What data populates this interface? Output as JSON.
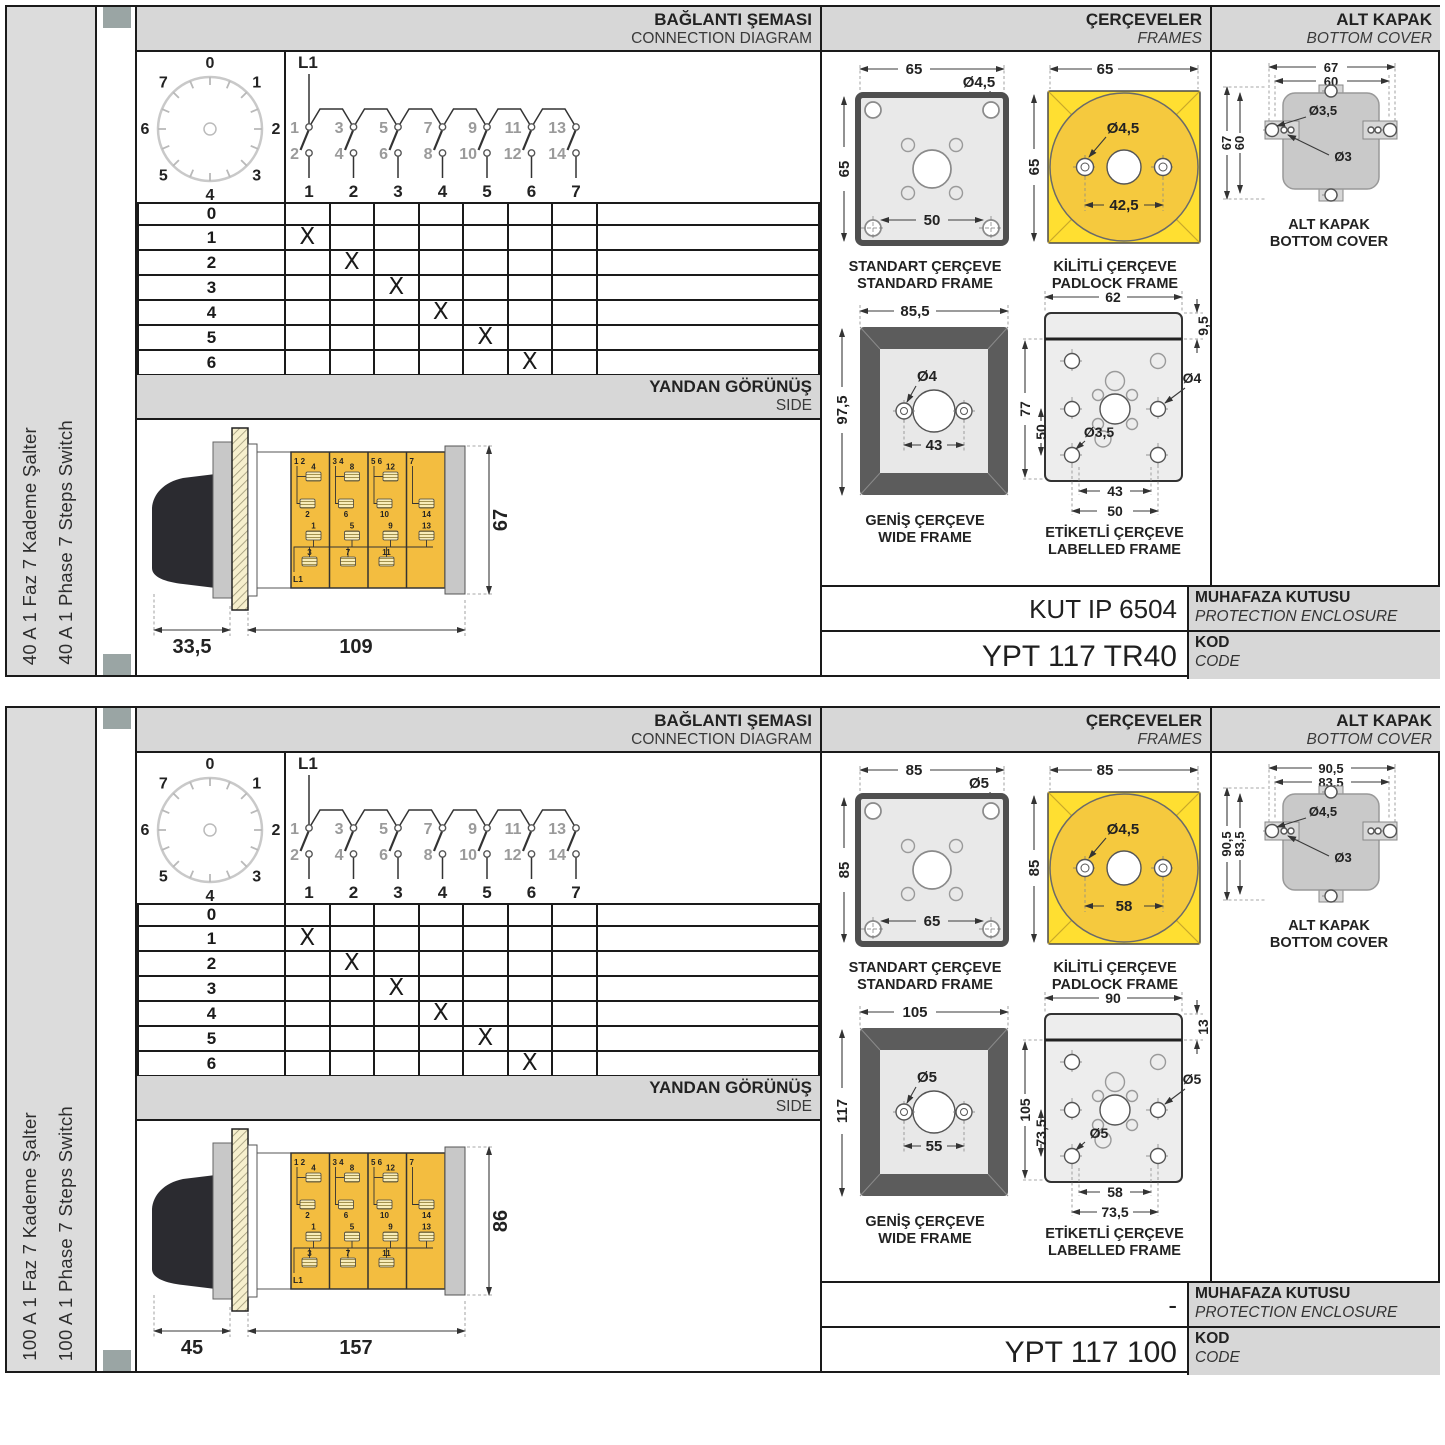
{
  "page": {
    "background": "#ffffff",
    "grid_line": "#1a1a1a",
    "header_bg": "#d7d7d7",
    "sidebar_bg": "#dcdcdc",
    "module_yellow": "#f3bd40",
    "padlock_yellow": "#ffdf31",
    "binder_square": "#9aa5a4"
  },
  "halves": [
    {
      "id": "40a",
      "sidebar": {
        "label_tr": "40 A 1 Faz 7 Kademe Şalter",
        "label_en": "40 A 1 Phase 7 Steps Switch"
      },
      "connection": {
        "title_tr": "BAĞLANTI ŞEMASI",
        "title_en": "CONNECTION DIAGRAM",
        "l1": "L1",
        "dial": [
          "0",
          "1",
          "2",
          "3",
          "4",
          "5",
          "6",
          "7"
        ],
        "top_terminals": [
          "1",
          "3",
          "5",
          "7",
          "9",
          "11",
          "13"
        ],
        "bottom_terminals": [
          "2",
          "4",
          "6",
          "8",
          "10",
          "12",
          "14"
        ],
        "columns": [
          "1",
          "2",
          "3",
          "4",
          "5",
          "6",
          "7"
        ]
      },
      "table": {
        "rows": [
          {
            "label": "0",
            "cells": [
              "",
              "",
              "",
              "",
              "",
              "",
              ""
            ]
          },
          {
            "label": "1",
            "cells": [
              "X",
              "",
              "",
              "",
              "",
              "",
              ""
            ]
          },
          {
            "label": "2",
            "cells": [
              "",
              "X",
              "",
              "",
              "",
              "",
              ""
            ]
          },
          {
            "label": "3",
            "cells": [
              "",
              "",
              "X",
              "",
              "",
              "",
              ""
            ]
          },
          {
            "label": "4",
            "cells": [
              "",
              "",
              "",
              "X",
              "",
              "",
              ""
            ]
          },
          {
            "label": "5",
            "cells": [
              "",
              "",
              "",
              "",
              "X",
              "",
              ""
            ]
          },
          {
            "label": "6",
            "cells": [
              "",
              "",
              "",
              "",
              "",
              "X",
              ""
            ]
          },
          {
            "label": "7",
            "cells": [
              "",
              "",
              "",
              "",
              "",
              "",
              "X"
            ]
          }
        ]
      },
      "side_view": {
        "title_tr": "YANDAN GÖRÜNÜŞ",
        "title_en": "SIDE",
        "dim_depth": "33,5",
        "dim_length": "109",
        "dim_height": "67",
        "l1": "L1",
        "corner_labels": [
          "1  2",
          "3  4",
          "5  6",
          "7"
        ],
        "upper_top_labels": [
          "4",
          "8",
          "12"
        ],
        "upper_bottom_labels": [
          "2",
          "6",
          "10",
          "14"
        ],
        "lower_top_labels": [
          "1",
          "5",
          "9",
          "13"
        ],
        "lower_bottom_labels": [
          "3",
          "7",
          "11"
        ]
      },
      "frames": {
        "title_tr": "ÇERÇEVELER",
        "title_en": "FRAMES",
        "standard": {
          "width": "65",
          "height": "65",
          "hole": "Ø4,5",
          "pitch": "50",
          "caption_tr": "STANDART ÇERÇEVE",
          "caption_en": "STANDARD FRAME"
        },
        "padlock": {
          "width": "65",
          "height": "65",
          "hole": "Ø4,5",
          "pitch": "42,5",
          "caption_tr": "KİLİTLİ ÇERÇEVE",
          "caption_en": "PADLOCK FRAME"
        },
        "wide": {
          "width": "85,5",
          "height": "97,5",
          "hole": "Ø4",
          "pitch": "43",
          "caption_tr": "GENİŞ ÇERÇEVE",
          "caption_en": "WIDE FRAME"
        },
        "labelled": {
          "width": "62",
          "strip_height": "9,5",
          "height": "77",
          "height_inner": "50",
          "hole_right": "Ø4",
          "hole_left": "Ø3,5",
          "pitch_inner": "43",
          "pitch_outer": "50",
          "caption_tr": "ETİKETLİ ÇERÇEVE",
          "caption_en": "LABELLED FRAME"
        }
      },
      "bottom_cover": {
        "title_tr": "ALT KAPAK",
        "title_en": "BOTTOM COVER",
        "width_outer": "67",
        "width_inner": "60",
        "height_outer": "67",
        "height_inner": "60",
        "hole_tab": "Ø3,5",
        "hole_small": "Ø3",
        "caption_tr": "ALT KAPAK",
        "caption_en": "BOTTOM COVER"
      },
      "enclosure": {
        "value": "KUT IP 6504",
        "label_tr": "MUHAFAZA KUTUSU",
        "label_en": "PROTECTION ENCLOSURE"
      },
      "code": {
        "value": "YPT 117 TR40",
        "label_tr": "KOD",
        "label_en": "CODE"
      }
    },
    {
      "id": "100a",
      "sidebar": {
        "label_tr": "100 A 1 Faz 7 Kademe Şalter",
        "label_en": "100 A 1 Phase 7 Steps Switch"
      },
      "connection": {
        "title_tr": "BAĞLANTI ŞEMASI",
        "title_en": "CONNECTION DIAGRAM",
        "l1": "L1",
        "dial": [
          "0",
          "1",
          "2",
          "3",
          "4",
          "5",
          "6",
          "7"
        ],
        "top_terminals": [
          "1",
          "3",
          "5",
          "7",
          "9",
          "11",
          "13"
        ],
        "bottom_terminals": [
          "2",
          "4",
          "6",
          "8",
          "10",
          "12",
          "14"
        ],
        "columns": [
          "1",
          "2",
          "3",
          "4",
          "5",
          "6",
          "7"
        ]
      },
      "table": {
        "rows": [
          {
            "label": "0",
            "cells": [
              "",
              "",
              "",
              "",
              "",
              "",
              ""
            ]
          },
          {
            "label": "1",
            "cells": [
              "X",
              "",
              "",
              "",
              "",
              "",
              ""
            ]
          },
          {
            "label": "2",
            "cells": [
              "",
              "X",
              "",
              "",
              "",
              "",
              ""
            ]
          },
          {
            "label": "3",
            "cells": [
              "",
              "",
              "X",
              "",
              "",
              "",
              ""
            ]
          },
          {
            "label": "4",
            "cells": [
              "",
              "",
              "",
              "X",
              "",
              "",
              ""
            ]
          },
          {
            "label": "5",
            "cells": [
              "",
              "",
              "",
              "",
              "X",
              "",
              ""
            ]
          },
          {
            "label": "6",
            "cells": [
              "",
              "",
              "",
              "",
              "",
              "X",
              ""
            ]
          },
          {
            "label": "7",
            "cells": [
              "",
              "",
              "",
              "",
              "",
              "",
              "X"
            ]
          }
        ]
      },
      "side_view": {
        "title_tr": "YANDAN GÖRÜNÜŞ",
        "title_en": "SIDE",
        "dim_depth": "45",
        "dim_length": "157",
        "dim_height": "86",
        "l1": "L1",
        "corner_labels": [
          "1  2",
          "3  4",
          "5  6",
          "7"
        ],
        "upper_top_labels": [
          "4",
          "8",
          "12"
        ],
        "upper_bottom_labels": [
          "2",
          "6",
          "10",
          "14"
        ],
        "lower_top_labels": [
          "1",
          "5",
          "9",
          "13"
        ],
        "lower_bottom_labels": [
          "3",
          "7",
          "11"
        ]
      },
      "frames": {
        "title_tr": "ÇERÇEVELER",
        "title_en": "FRAMES",
        "standard": {
          "width": "85",
          "height": "85",
          "hole": "Ø5",
          "pitch": "65",
          "caption_tr": "STANDART ÇERÇEVE",
          "caption_en": "STANDARD FRAME"
        },
        "padlock": {
          "width": "85",
          "height": "85",
          "hole": "Ø4,5",
          "pitch": "58",
          "caption_tr": "KİLİTLİ ÇERÇEVE",
          "caption_en": "PADLOCK FRAME"
        },
        "wide": {
          "width": "105",
          "height": "117",
          "hole": "Ø5",
          "pitch": "55",
          "caption_tr": "GENİŞ ÇERÇEVE",
          "caption_en": "WIDE FRAME"
        },
        "labelled": {
          "width": "90",
          "strip_height": "13",
          "height": "105",
          "height_inner": "73,5",
          "hole_right": "Ø5",
          "hole_left": "Ø5",
          "pitch_inner": "58",
          "pitch_outer": "73,5",
          "caption_tr": "ETİKETLİ ÇERÇEVE",
          "caption_en": "LABELLED FRAME"
        }
      },
      "bottom_cover": {
        "title_tr": "ALT KAPAK",
        "title_en": "BOTTOM COVER",
        "width_outer": "90,5",
        "width_inner": "83,5",
        "height_outer": "90,5",
        "height_inner": "83,5",
        "hole_tab": "Ø4,5",
        "hole_small": "Ø3",
        "caption_tr": "ALT KAPAK",
        "caption_en": "BOTTOM COVER"
      },
      "enclosure": {
        "value": "-",
        "label_tr": "MUHAFAZA KUTUSU",
        "label_en": "PROTECTION ENCLOSURE"
      },
      "code": {
        "value": "YPT 117 100",
        "label_tr": "KOD",
        "label_en": "CODE"
      }
    }
  ]
}
